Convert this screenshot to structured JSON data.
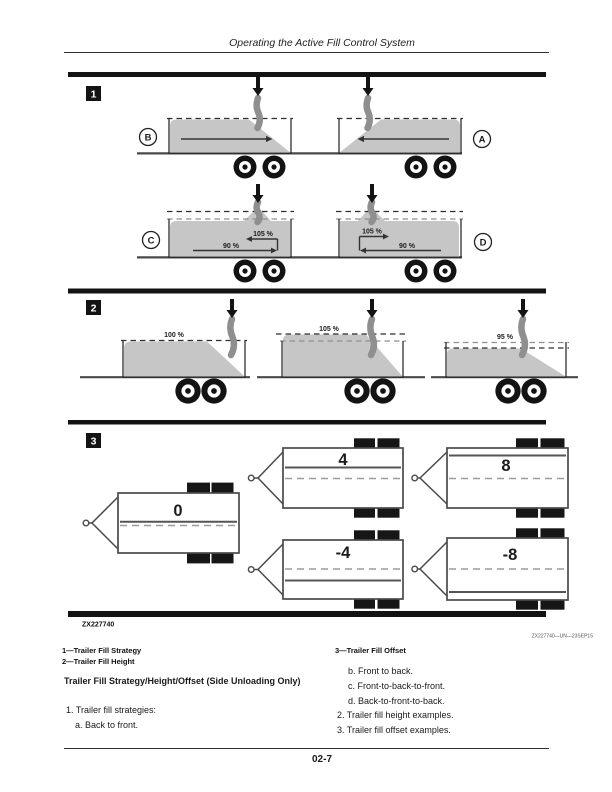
{
  "page": {
    "header_title": "Operating the Active Fill Control System",
    "page_number": "02-7"
  },
  "figure": {
    "figure_id": "ZX227740",
    "credit": "ZX227740—UN—23SEP15",
    "panel1": {
      "badge": "1",
      "labels": {
        "a": "A",
        "b": "B",
        "c": "C",
        "d": "D"
      },
      "c": {
        "top": "105 %",
        "bottom": "90 %"
      },
      "d": {
        "top": "105 %",
        "bottom": "90 %"
      }
    },
    "panel2": {
      "badge": "2",
      "levels": [
        "100 %",
        "105 %",
        "95 %"
      ]
    },
    "panel3": {
      "badge": "3",
      "offsets": [
        "0",
        "4",
        "8",
        "-4",
        "-8"
      ]
    }
  },
  "legend": {
    "items": [
      "1—Trailer Fill Strategy",
      "2—Trailer Fill Height",
      "3—Trailer Fill Offset"
    ]
  },
  "body": {
    "heading": "Trailer Fill Strategy/Height/Offset (Side Unloading Only)",
    "item1": "1. Trailer fill strategies:",
    "item1a": "a. Back to front.",
    "item1b": "b. Front to back.",
    "item1c": "c. Front-to-back-to-front.",
    "item1d": "d. Back-to-front-to-back.",
    "item2": "2. Trailer fill height examples.",
    "item3": "3. Trailer fill offset examples."
  }
}
